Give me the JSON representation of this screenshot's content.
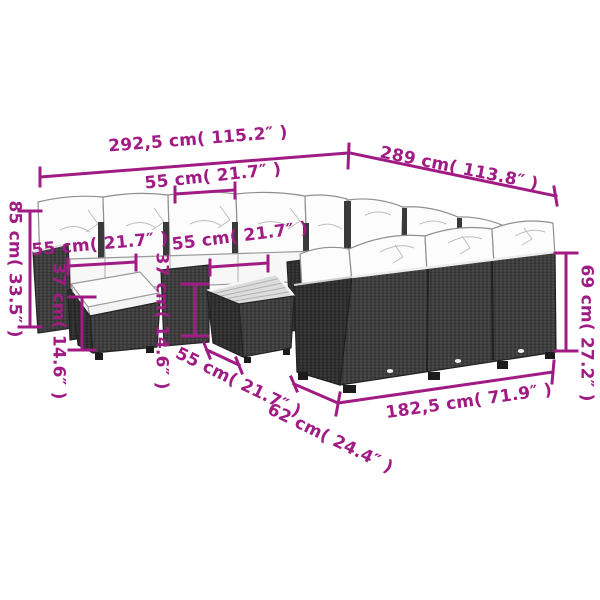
{
  "figure": {
    "kind": "product dimension diagram",
    "subject": "rattan garden lounge sofa set with footstool and coffee table",
    "accent_color": "#A01C84",
    "line_art_color": "#3d3d3d",
    "background": "#ffffff"
  },
  "dims": {
    "total_front_width": "292,5 cm( 115.2″ )",
    "total_side_length": "289 cm( 113.8″ )",
    "seat_width": "55 cm( 21.7″ )",
    "stool_top_width": "55 cm( 21.7″ )",
    "table_top_width": "55 cm( 21.7″ )",
    "table_depth": "55 cm( 21.7″ )",
    "stool_height": "37 cm( 14.6″ )",
    "table_height": "37 cm( 14.6″ )",
    "left_back_height": "85 cm( 33.5″ )",
    "right_back_height": "69 cm( 27.2″ )",
    "right_front_length": "182,5 cm( 71.9″ )",
    "right_depth": "62 cm( 24.4″ )"
  }
}
